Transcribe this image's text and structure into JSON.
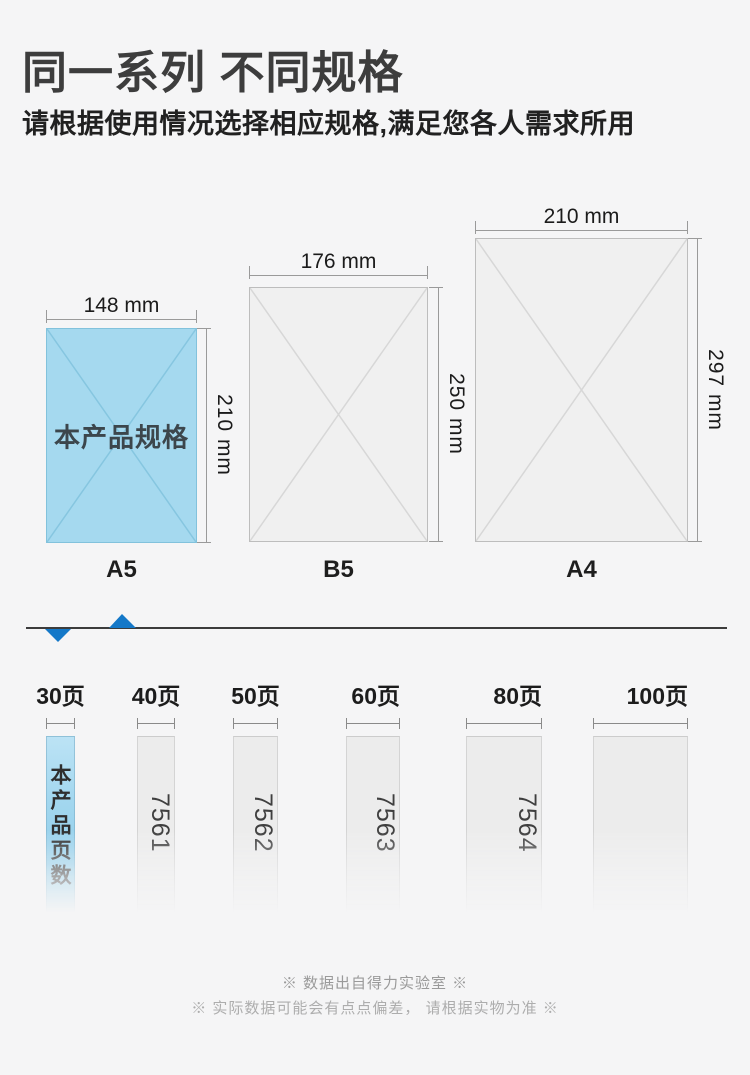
{
  "page": {
    "background": "#f5f5f6",
    "accent_blue": "#1478c8",
    "highlight_fill": "#a5d9ef"
  },
  "header": {
    "title": "同一系列 不同规格",
    "subtitle": "请根据使用情况选择相应规格,满足您各人需求所用"
  },
  "sizes": [
    {
      "name": "A5",
      "width_label": "148 mm",
      "height_label": "210 mm",
      "note": "本产品规格",
      "highlighted": true
    },
    {
      "name": "B5",
      "width_label": "176 mm",
      "height_label": "250 mm",
      "highlighted": false
    },
    {
      "name": "A4",
      "width_label": "210 mm",
      "height_label": "297 mm",
      "highlighted": false
    }
  ],
  "page_options": [
    {
      "label": "30页",
      "note": "本产品页数",
      "code": "",
      "highlighted": true
    },
    {
      "label": "40页",
      "code": "7561",
      "highlighted": false
    },
    {
      "label": "50页",
      "code": "7562",
      "highlighted": false
    },
    {
      "label": "60页",
      "code": "7563",
      "highlighted": false
    },
    {
      "label": "80页",
      "code": "7564",
      "highlighted": false
    },
    {
      "label": "100页",
      "code": "",
      "highlighted": false
    }
  ],
  "footer": {
    "note1": "※ 数据出自得力实验室 ※",
    "note2": "※ 实际数据可能会有点点偏差， 请根据实物为准 ※"
  }
}
